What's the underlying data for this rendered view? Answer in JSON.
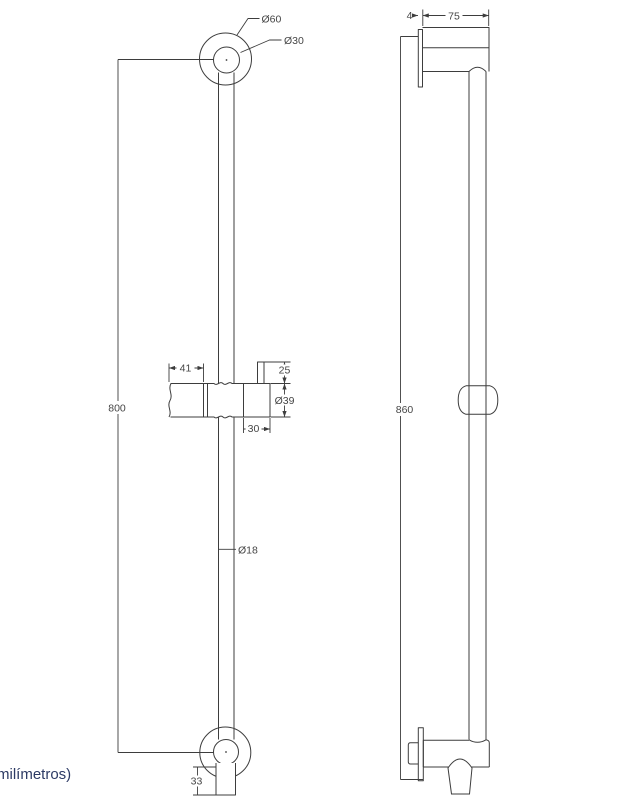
{
  "drawing": {
    "units_note": "milímetros)",
    "front_view": {
      "top_mount_outer_diameter": "Ø60",
      "top_mount_inner_diameter": "Ø30",
      "overall_height": "800",
      "slider_grip_length": "41",
      "slider_post_height": "25",
      "slider_body_diameter": "Ø39",
      "slider_bracket_width": "30",
      "bar_diameter": "Ø18",
      "outlet_height": "33"
    },
    "side_view": {
      "plate_thickness": "4",
      "mount_depth": "75",
      "overall_height": "860"
    },
    "colors": {
      "line": "#3d3d3d",
      "dimension_text": "#454545",
      "units_text": "#2c3a64"
    }
  }
}
